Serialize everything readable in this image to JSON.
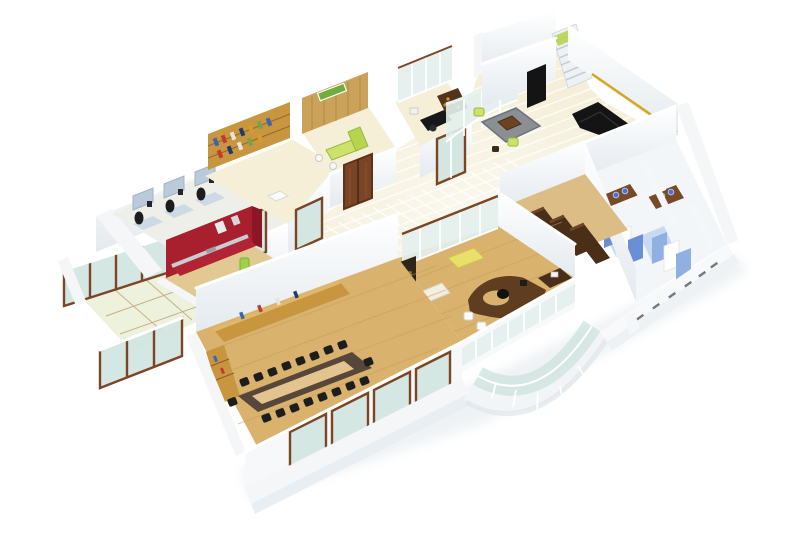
{
  "scene": {
    "type": "3d-isometric-floor-plan-render",
    "description": "3D cutaway render of an office floor plan on a white background, viewed from above at an angle",
    "label": "3D office floor plan render"
  },
  "rooms": [
    {
      "name": "open-workstation-area",
      "features": "blue cubicle desks with three seated workers"
    },
    {
      "name": "library-room",
      "features": "wooden bookshelf wall with colored books"
    },
    {
      "name": "reception-cabin",
      "features": "wood panel wall with green sign, lime green desk"
    },
    {
      "name": "manager-cabin",
      "features": "black desk, brown bookshelf cabinet, glass door"
    },
    {
      "name": "entry-lobby",
      "features": "cream glossy tile floor, curved glass screen, gray rug, lime poufs, black sofa"
    },
    {
      "name": "elevator-and-stairs",
      "features": "lime green elevator floor, black door, white staircase"
    },
    {
      "name": "toilets",
      "features": "blue partition stalls, wood vanities with blue basins"
    },
    {
      "name": "storage-room",
      "features": "rows of tall dark brown cabinets"
    },
    {
      "name": "executive-office",
      "features": "curved brown desk, black chair, white guest chairs, yellow sofa, glass walls"
    },
    {
      "name": "conference-room",
      "features": "long dark table with light wood inlay, black chairs, wooden credenza"
    },
    {
      "name": "pantry",
      "features": "red walls and counter, green water cooler"
    },
    {
      "name": "glass-terrace",
      "features": "glass floor panels and brown framed glass balustrades"
    },
    {
      "name": "curved-atrium",
      "features": "curved glass curtain wall at south face"
    }
  ],
  "colors": {
    "bg": "#ffffff",
    "wall-face": "#f2f5f8",
    "wall-shade": "#dfe5ea",
    "floor-tile": "#f5efd8",
    "floor-tint": "#edefe8",
    "wood-floor": "#d9b36e",
    "wood-light": "#e2c991",
    "wood-shelf": "#c8963f",
    "wood-dark": "#7a4526",
    "cabinet-dark": "#4a2e18",
    "table-dark": "#57473a",
    "table-inlay": "#e3c48f",
    "chair-black": "#1d1d1f",
    "red-wall": "#a81f2e",
    "red-deep": "#8c1624",
    "lime": "#b6d44e",
    "lime-light": "#cde26a",
    "glass": "#cfe4df",
    "glass-light": "#e3f0ed",
    "glass-frame": "#7c4524",
    "blue-partition": "#6b8fd6",
    "blue-partition-light": "#8fb0e0",
    "blue-floor": "#c9d9f2",
    "sink-blue": "#4a6fd0",
    "vanity-brown": "#7a4a28",
    "couch-black": "#141414",
    "gold-trim": "#d9a520",
    "desk-blue": "#b9cbd9",
    "rug-gray": "#8a8f94",
    "shadow": "#e3e8ec"
  }
}
